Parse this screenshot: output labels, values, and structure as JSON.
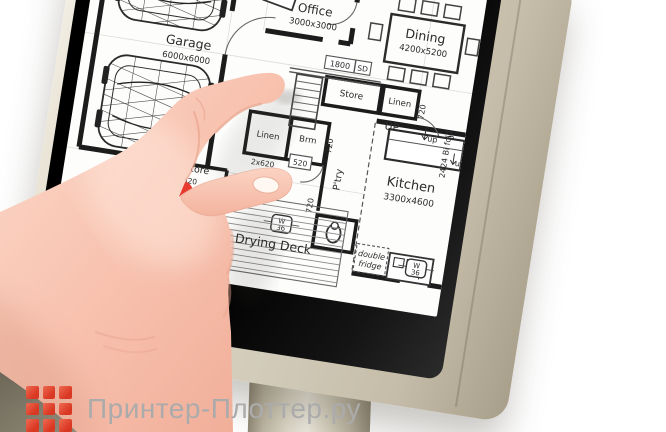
{
  "watermark": {
    "text": "Принтер-Плоттер.ру",
    "logo_color": "#e2402e"
  },
  "plan": {
    "garage": {
      "name": "Garage",
      "dims": "6000x6000"
    },
    "office": {
      "name": "Office",
      "dims": "3000x3000"
    },
    "dining": {
      "name": "Dining",
      "dims": "4200x5200"
    },
    "kitchen": {
      "name": "Kitchen",
      "dims": "3300x4600"
    },
    "pantry": "P'try",
    "drying_deck": "Drying Deck",
    "store_top": "Store",
    "store_rear": "Store",
    "store_rear_dim": "620",
    "linen_top": "Linen",
    "linen_bottom": "Linen",
    "bathroom": "Brm",
    "up_label": "UP",
    "up_small": "up",
    "door_width": "720",
    "door_width_small": "520",
    "double_door": "2x620",
    "sliding_door_dim": "1800",
    "sliding_door_tag": "SD",
    "fridge_line1": "double",
    "fridge_line2": "fridge",
    "bifold": "2424 Bi fold",
    "window_w": "W",
    "window_num": "36"
  },
  "colors": {
    "brand_red": "#e2402e",
    "marker_red": "#e8392e",
    "casing_beige": "#d7d0be",
    "bezel_black": "#0d0d0d",
    "skin_tone": "#f6c1b0"
  }
}
